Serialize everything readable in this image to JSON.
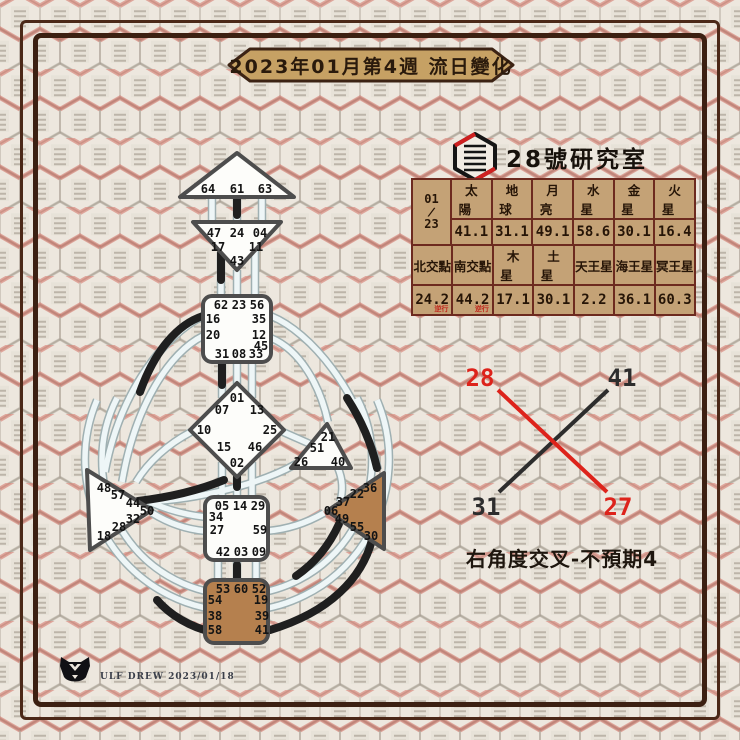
{
  "title": "2023年01月第4週 流日變化",
  "lab": {
    "name": "28號研究室",
    "icon": "hexagram-hexagon-logo"
  },
  "table": {
    "date": {
      "month": "01",
      "sep": "/",
      "day": "23"
    },
    "row1_headers": [
      "太陽",
      "地球",
      "月亮",
      "水星",
      "金星",
      "火星"
    ],
    "row1_values": [
      "41.1",
      "31.1",
      "49.1",
      "58.6",
      "30.1",
      "16.4"
    ],
    "row2_headers": [
      "北交點",
      "南交點",
      "木星",
      "土星",
      "天王星",
      "海王星",
      "冥王星"
    ],
    "row2_values": [
      "24.2",
      "44.2",
      "17.1",
      "30.1",
      "2.2",
      "36.1",
      "60.3"
    ],
    "retrograde_label": "逆行"
  },
  "cross": {
    "top_left": "28",
    "top_right": "41",
    "bottom_left": "31",
    "bottom_right": "27",
    "caption": "右角度交叉-不預期4",
    "red": "#dd231b",
    "black": "#2d2d2d"
  },
  "bodygraph": {
    "head": [
      "64",
      "61",
      "63"
    ],
    "ajna": [
      "47",
      "24",
      "04",
      "17",
      "11",
      "43"
    ],
    "throat": [
      "62",
      "23",
      "56",
      "16",
      "35",
      "20",
      "12",
      "45",
      "31",
      "08",
      "33"
    ],
    "g": [
      "01",
      "07",
      "13",
      "10",
      "25",
      "15",
      "46",
      "02"
    ],
    "heart": [
      "21",
      "51",
      "26",
      "40"
    ],
    "spleen": [
      "48",
      "57",
      "44",
      "50",
      "32",
      "28",
      "18"
    ],
    "solar": [
      "36",
      "22",
      "37",
      "06",
      "49",
      "55",
      "30"
    ],
    "sacral": [
      "05",
      "14",
      "29",
      "34",
      "27",
      "59",
      "42",
      "03",
      "09"
    ],
    "root": [
      "53",
      "60",
      "52",
      "54",
      "19",
      "38",
      "39",
      "58",
      "41"
    ],
    "defined_color": "#b5804e",
    "open_color": "#fdfdfa"
  },
  "footer": {
    "credit": "ULF DREW 2023/01/18"
  },
  "colors": {
    "banner_fill": "#c6a164",
    "frame": "#3c2012",
    "table_bg": "#c4a276",
    "accent_red": "#c0271c"
  }
}
